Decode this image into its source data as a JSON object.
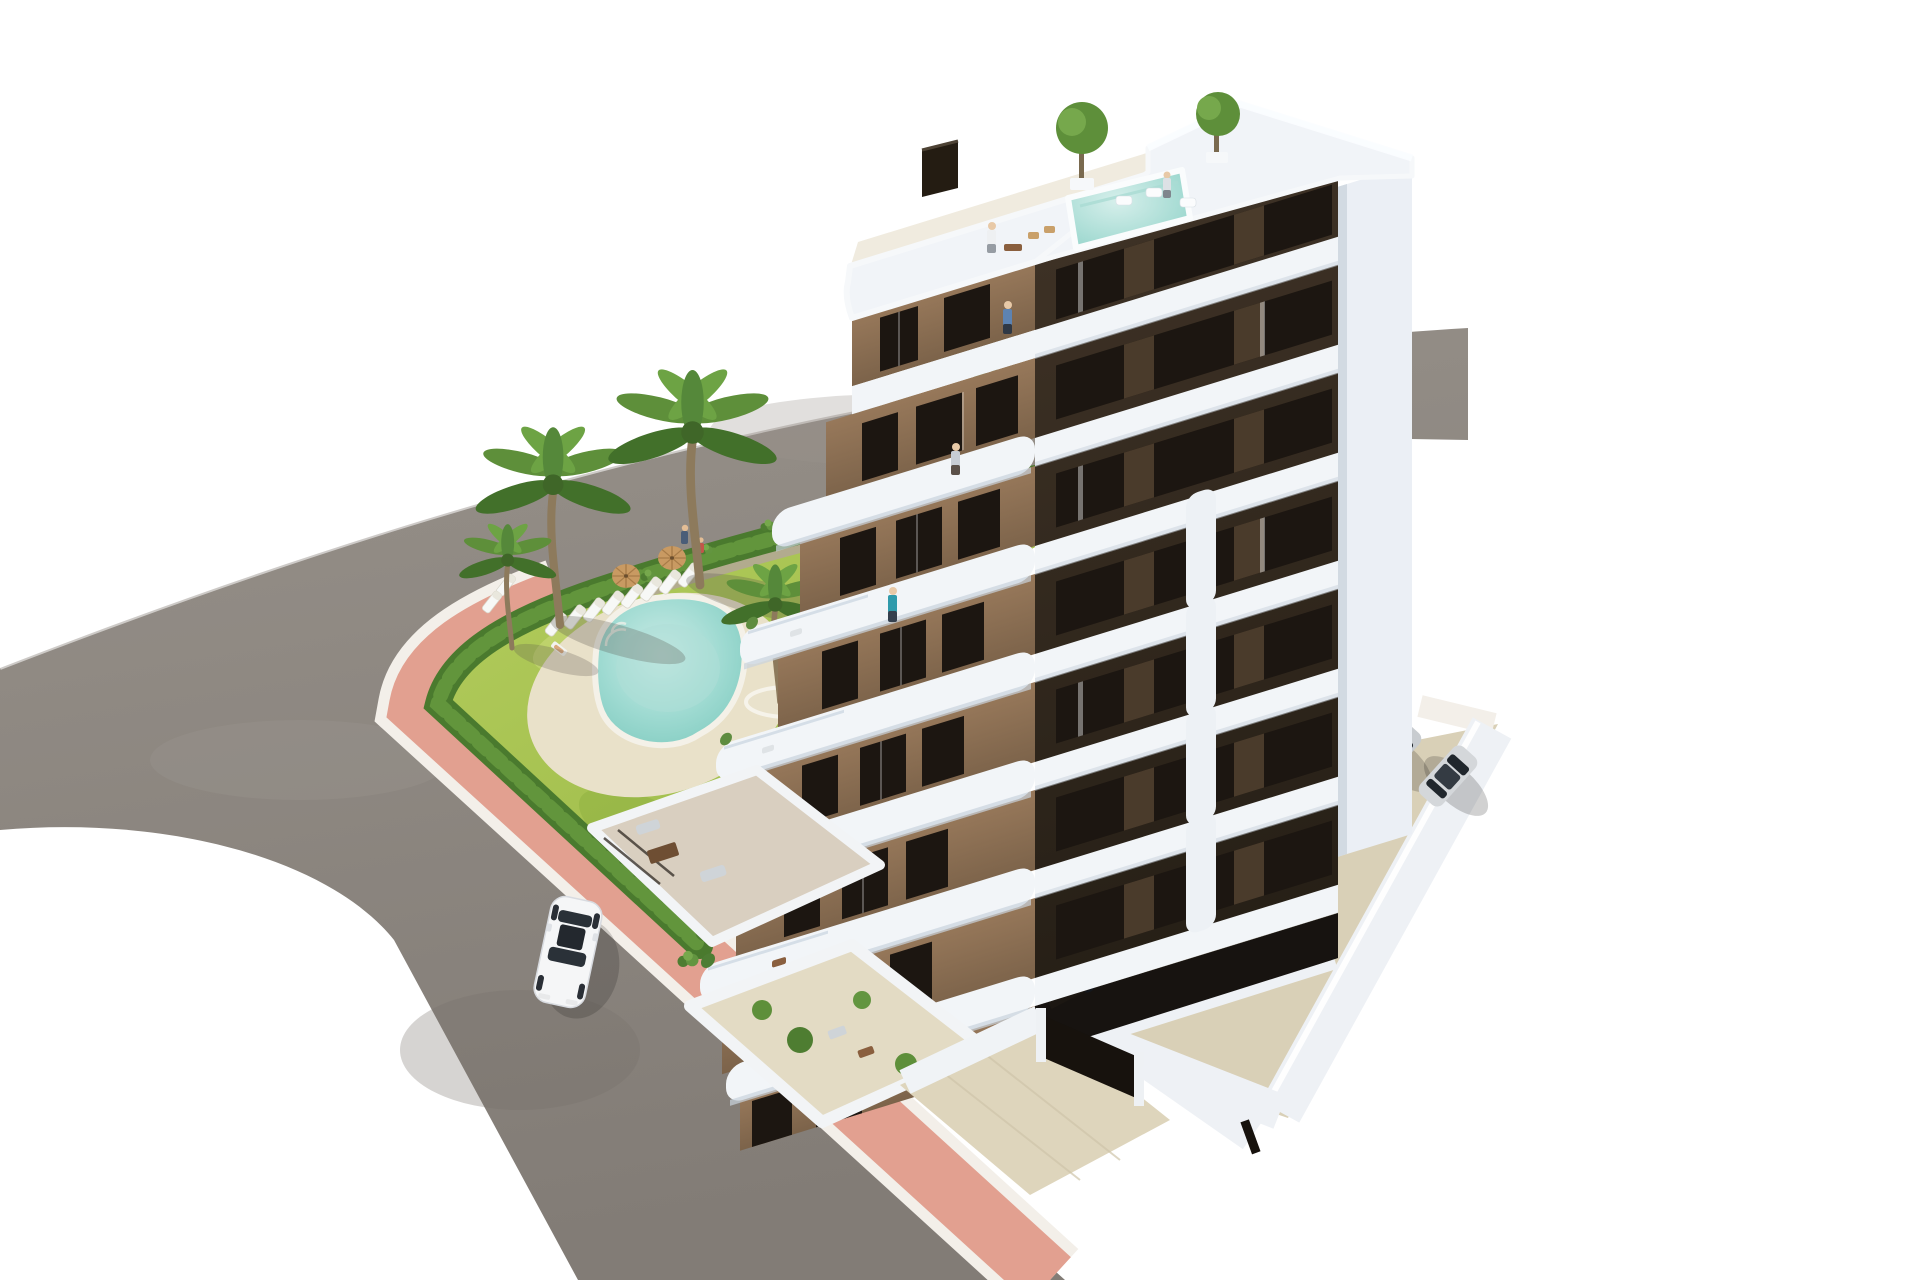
{
  "scene": {
    "title": "New-build apartment complex - aerial 3D architectural render",
    "description": "Aerial architectural rendering of a modern seven-storey apartment building with white wrap-around balconies, brown facades, rooftop terraces and a rooftop plunge pool. A landscaped communal garden with a free-form turquoise swimming pool, sun loungers, parasols and palm trees is bordered by a green hedge and a pink pavement along a curved asphalt road. A white car drives on the road; silver and dark cars are parked in the residents' parking area beside and under the building.",
    "background": "#ffffff"
  },
  "colors": {
    "bg": "#ffffff",
    "asphalt": "#8a847e",
    "asphalt_light": "#97918a",
    "sidewalk": "#e2a090",
    "curb": "#f3efe9",
    "hedge": "#4a7a2e",
    "hedge_light": "#62953c",
    "lawn": "#a3c24f",
    "lawn_dark": "#8fb23e",
    "gravel": "#b3a795",
    "sand": "#e9e1c9",
    "pool": "#84cec3",
    "pool_light": "#b9e6df",
    "facade_brown": "#8d7355",
    "facade_brown_dark": "#7a6248",
    "facade_dark": "#362b20",
    "window_dark": "#1c1611",
    "slab_white": "#f2f5f8",
    "slab_shade": "#c9d3dd",
    "roof_white": "#f1f4f8",
    "core_white": "#ebeff5",
    "terrace_floor": "#efeade",
    "concrete": "#d9d0b7",
    "concrete_shadow": "#bcae92",
    "wall_white": "#eef1f5",
    "gate_dark": "#17120d",
    "palm": "#5e8f3a",
    "palm_dark": "#42702a",
    "trunk": "#8d7a5c",
    "umbrella": "#c99a62",
    "car_white": "#f5f6f7",
    "car_silver": "#cbcfd3",
    "car_navy": "#242b36",
    "car_dark": "#14171c",
    "people_teal": "#2f9aab"
  },
  "objects": {
    "building": {
      "name": "apartment-building",
      "floors": 7,
      "facade_left": "brown",
      "facade_right": "dark-brown",
      "features": [
        "white wrap-around balconies",
        "rooftop plunge pool",
        "roof terraces",
        "ground-floor patios",
        "parking under building"
      ]
    },
    "garden": {
      "name": "communal-garden",
      "features": [
        "free-form swimming pool",
        "sun loungers",
        "parasols",
        "palm trees",
        "lawn",
        "perimeter hedge",
        "gravel planting strip"
      ]
    },
    "road": {
      "name": "asphalt-road"
    },
    "sidewalk": {
      "name": "pink-pavement"
    },
    "white_car": {
      "name": "white-car-on-road"
    },
    "parking": {
      "name": "residents-parking",
      "visible_cars": 6
    },
    "entrance": {
      "name": "gated-entrance-driveway"
    }
  },
  "counts": {
    "palm_trees": 6,
    "sun_loungers": 10,
    "parasols": 2,
    "parked_cars": 6,
    "roof_plants": 2,
    "people": 9
  }
}
